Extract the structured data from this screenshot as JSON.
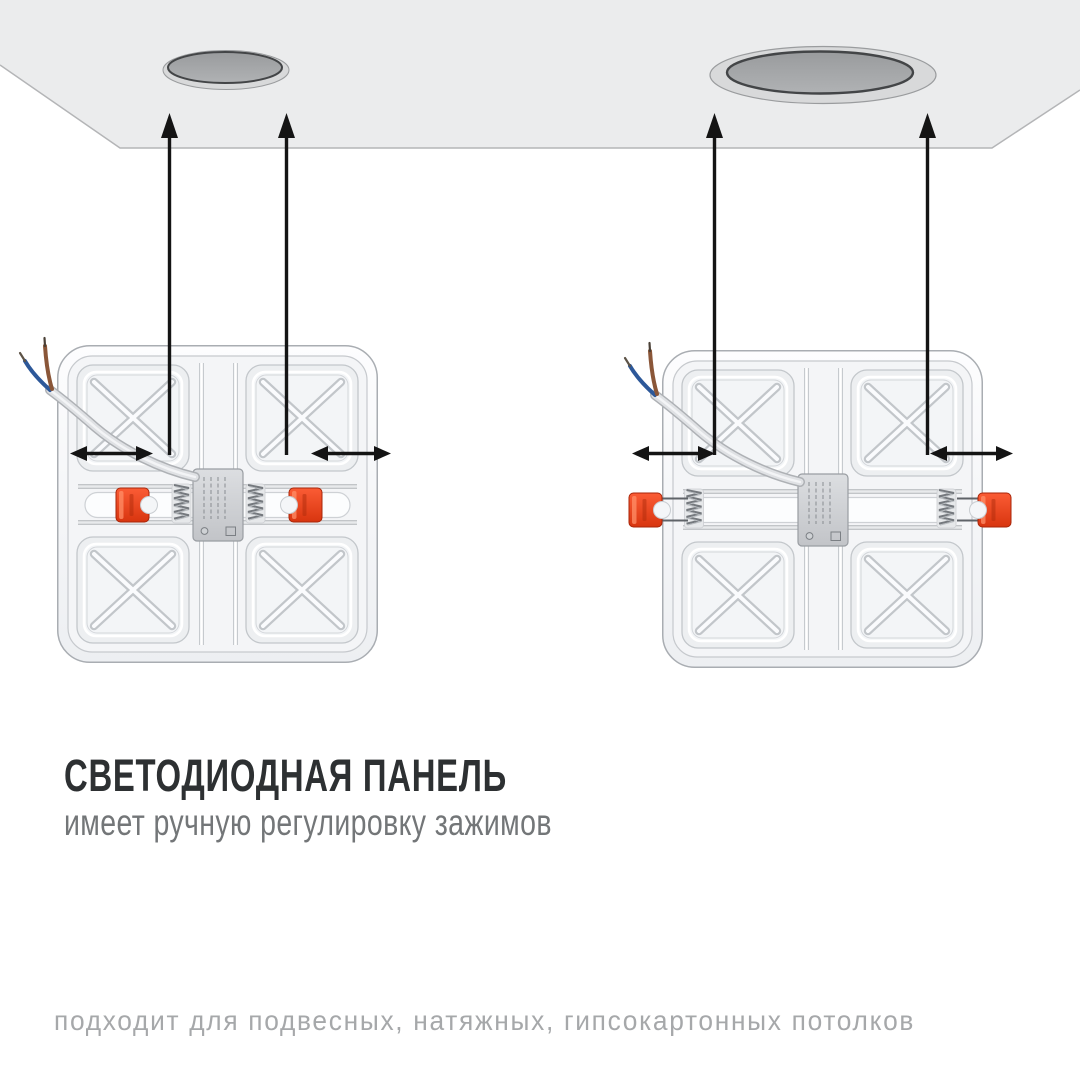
{
  "heading": {
    "title": "СВЕТОДИОДНАЯ ПАНЕЛЬ",
    "subtitle": "имеет ручную регулировку зажимов"
  },
  "footer": {
    "note": "подходит для подвесных, натяжных, гипсокартонных потолков"
  },
  "colors": {
    "background": "#ffffff",
    "ceiling": "#ebeced",
    "ceiling_edge": "#b4b5b7",
    "hole_ring": "#d8d9da",
    "hole_ring_edge": "#9a9c9e",
    "hole_inner": "#a7a9ab",
    "hole_outline": "#434547",
    "arrow": "#141414",
    "clip_red_light": "#fb5c35",
    "clip_red_dark": "#d8350f",
    "clip_red_stroke": "#a8260a",
    "panel_edge": "#a9adb2",
    "panel_face": "#f4f5f7",
    "pocket_fill": "#edeff1",
    "rib_shadow": "#c2c6ca",
    "rib_highlight": "#fafbfd",
    "wire_blue": "#2d5899",
    "wire_brown": "#8a5638",
    "title_text": "#2d3032",
    "subtitle_text": "#737678",
    "footer_text": "#a6a8aa"
  },
  "scene": {
    "ceiling": {
      "description": "ceiling plane with two round mounting cutouts"
    },
    "holes": [
      {
        "side": "left",
        "size": "small"
      },
      {
        "side": "right",
        "size": "large"
      }
    ],
    "panels": [
      {
        "side": "left",
        "clip_state": "retracted"
      },
      {
        "side": "right",
        "clip_state": "extended"
      }
    ]
  }
}
